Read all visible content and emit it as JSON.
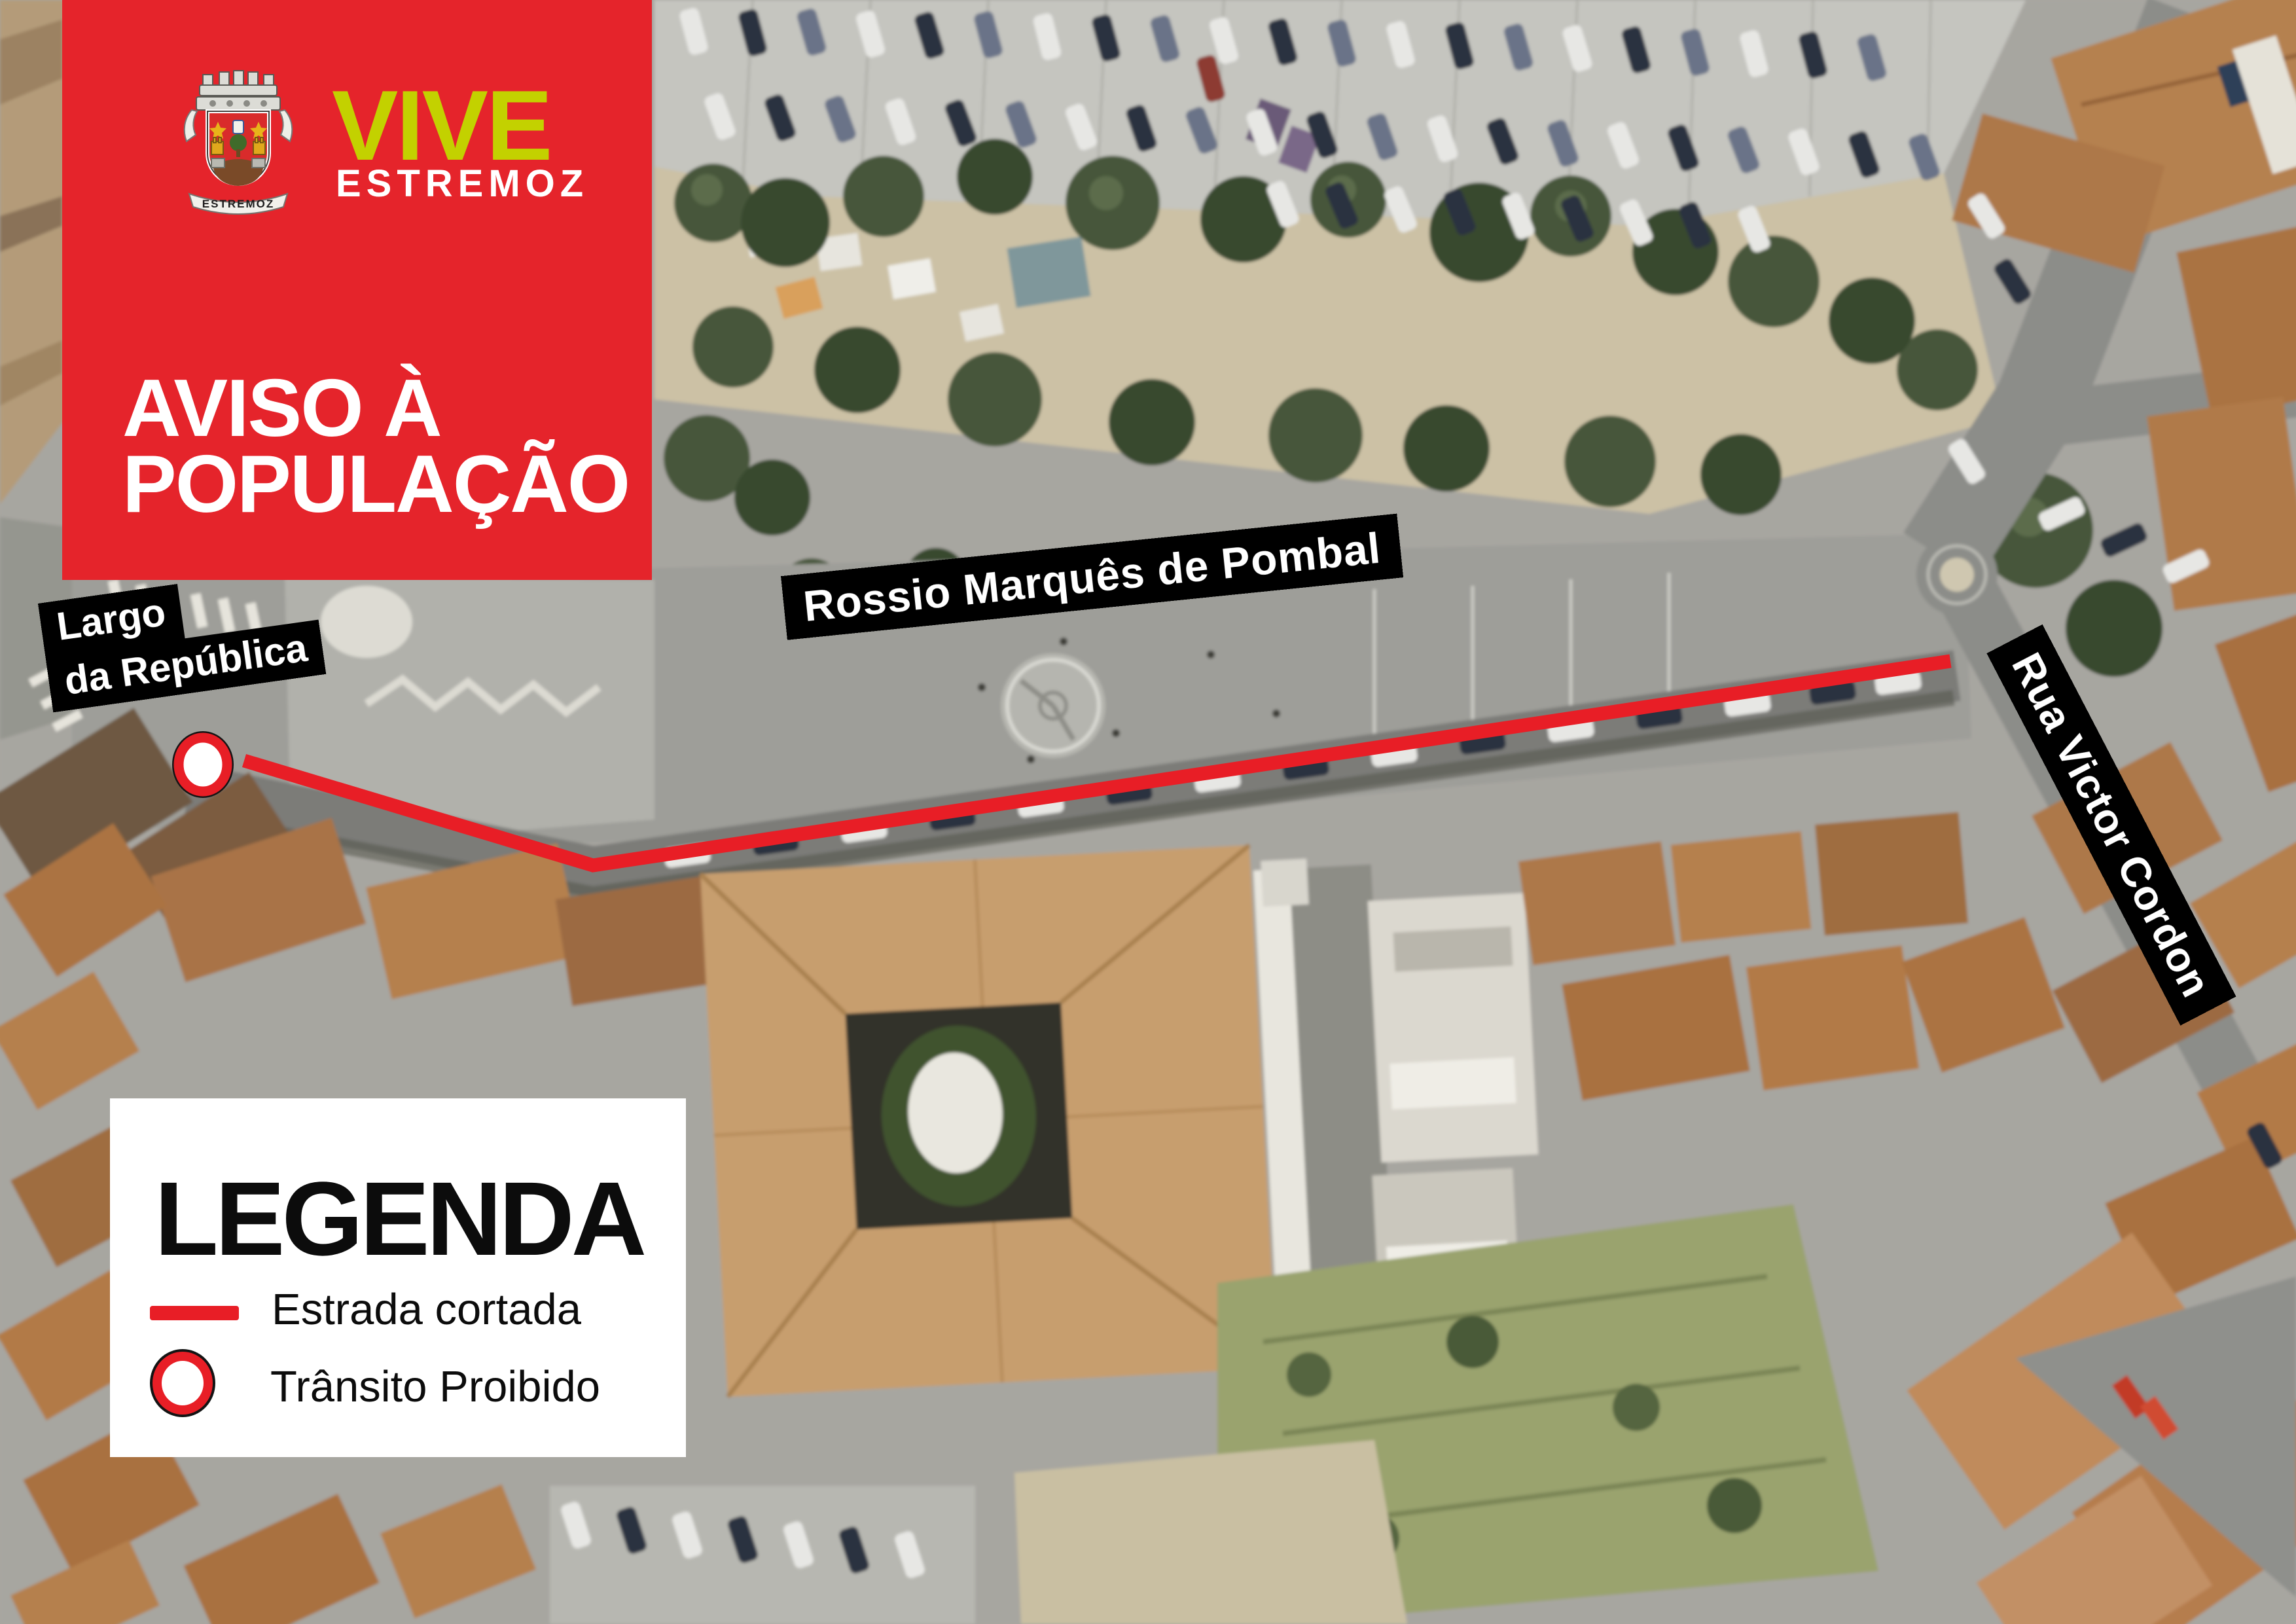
{
  "banner": {
    "crest_motto": "ESTREMOZ",
    "brand_top": "VIVE",
    "brand_bottom": "ESTREMOZ",
    "heading_line1": "AVISO À",
    "heading_line2": "POPULAÇÃO"
  },
  "map_labels": {
    "largo_line1": "Largo",
    "largo_line2": "da República",
    "rossio": "Rossio Marquês de Pombal",
    "rua": "Rua Victor Cordon"
  },
  "legend": {
    "title": "LEGENDA",
    "items": [
      {
        "symbol": "red-line",
        "label": "Estrada cortada"
      },
      {
        "symbol": "no-entry-ring",
        "label": "Trânsito Proibido"
      }
    ]
  },
  "colors": {
    "banner_red": "#e5242b",
    "brand_yellow": "#c3d100",
    "line_red": "#e81e26",
    "label_black": "#000000",
    "legend_white": "#ffffff"
  }
}
